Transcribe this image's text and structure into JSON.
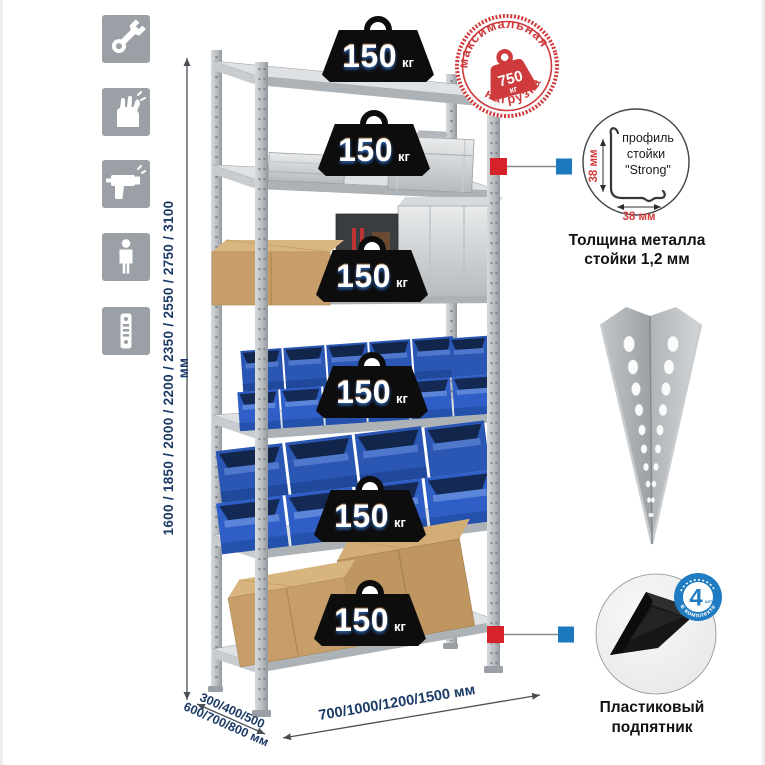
{
  "left_sidebar": {
    "icons": [
      {
        "name": "wrench"
      },
      {
        "name": "gloves"
      },
      {
        "name": "drill"
      },
      {
        "name": "person"
      },
      {
        "name": "rack-post"
      }
    ]
  },
  "dimensions": {
    "height_options": "1600 / 1850 / 2000 / 2200 / 2350 / 2550 / 2750 / 3100 мм",
    "depth_options_line1": "300/400/500",
    "depth_options_line2": "600/700/800 мм",
    "width_options": "700/1000/1200/1500 мм"
  },
  "rack": {
    "shelves": [
      {
        "load": "150",
        "unit": "кг"
      },
      {
        "load": "150",
        "unit": "кг"
      },
      {
        "load": "150",
        "unit": "кг"
      },
      {
        "load": "150",
        "unit": "кг"
      },
      {
        "load": "150",
        "unit": "кг"
      },
      {
        "load": "150",
        "unit": "кг"
      }
    ]
  },
  "max_load_stamp": {
    "arc_top": "максимальная",
    "arc_bottom": "нагрузка",
    "value": "750",
    "unit": "кг"
  },
  "profile_detail": {
    "label_line1": "профиль",
    "label_line2": "стойки",
    "label_line3": "\"Strong\"",
    "vertical_dim": "38 мм",
    "horizontal_dim": "38 мм",
    "caption_line1": "Толщина металла",
    "caption_line2": "стойки 1,2 мм"
  },
  "foot_detail": {
    "badge_value": "4",
    "badge_unit": "штуки",
    "badge_arc": "в комплекте",
    "caption_line1": "Пластиковый",
    "caption_line2": "подпятник"
  },
  "colors": {
    "stamp_red": "#cf3a3c",
    "accent_red": "#d6232b",
    "accent_blue": "#1d78be",
    "navy_text": "#1b3a66",
    "bin_blue": "#2e5ec6"
  }
}
